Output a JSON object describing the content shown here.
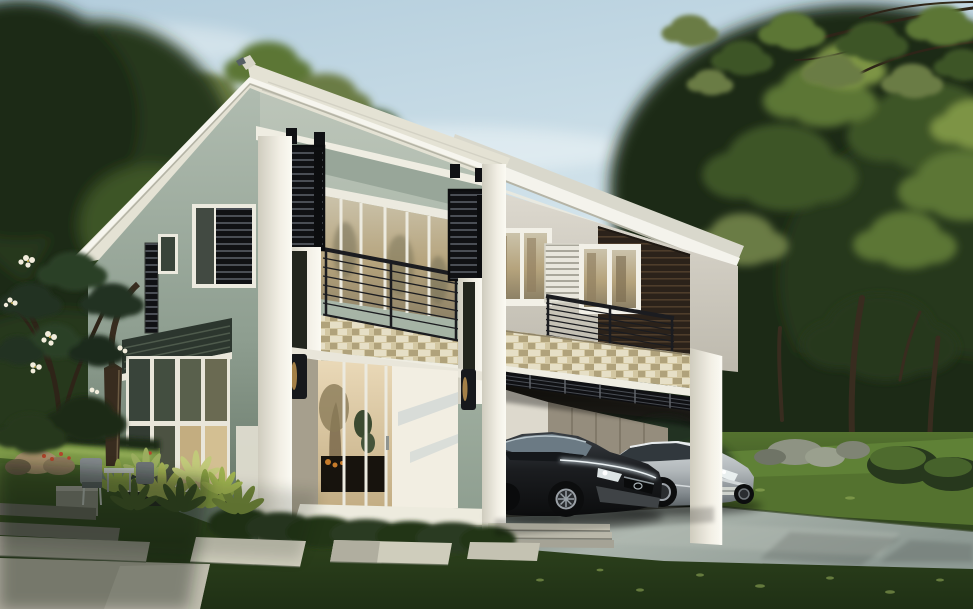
{
  "scene": {
    "type": "architectural-exterior-render",
    "description": "Photorealistic render of a modern two-storey tropical house with sage-green and white walls, black louvre screen panels, stone veneer bands, balconies with black railings, a carport sheltering two cars (dark hatchback and silver sedan), a concrete driveway, stepping-stone path, lawn and dense surrounding trees under a pale blue sky.",
    "objects": [
      "sky",
      "clouds",
      "tree-canopy-left",
      "tree-canopy-right",
      "overhanging-branch",
      "house",
      "left-wing-roof",
      "right-wing-roof",
      "balcony-left",
      "balcony-right",
      "louvre-panels",
      "stone-veneer-bands",
      "wood-slat-wall",
      "windows",
      "sliding-glass-doors",
      "wall-sconces",
      "carport",
      "carport-columns",
      "dark-hatchback-car",
      "silver-sedan-car",
      "driveway",
      "steps",
      "stepping-stones",
      "lawn",
      "garden-shrubs",
      "planter-box",
      "outdoor-furniture",
      "rocks",
      "plumeria-tree",
      "hedges"
    ]
  },
  "palette": {
    "sky-top": "#b3cddc",
    "sky-mid": "#d6e6ed",
    "sky-low": "#eef3f2",
    "cloud": "#f6fafa",
    "foliage-deep": "#1d2b16",
    "foliage-dark": "#27381d",
    "foliage-mid": "#3d5526",
    "foliage-light": "#5c7634",
    "foliage-bright": "#7d9445",
    "foliage-pale": "#9aad5e",
    "foliage-olive": "#6b7b44",
    "trunk": "#382c1f",
    "branch": "#2e2418",
    "wall-sage": "#b2bdb2",
    "wall-sage-dark": "#93a295",
    "wall-sage-deep": "#64735f",
    "wall-warm": "#d6d3c9",
    "fascia": "#f4f3ec",
    "soffit": "#c9c8ba",
    "roof-cream": "#e4e2d4",
    "roof-gray": "#d9d8cc",
    "column-white": "#efece2",
    "column-shade": "#d2cfc2",
    "louver-black": "#101114",
    "louver-gap": "#4a4e55",
    "rail-black": "#1b1c20",
    "stone-tan": "#d3c7a2",
    "stone-light": "#e6dfc6",
    "stone-dark": "#b0a27b",
    "wood-dark": "#2b221a",
    "wood-light": "#4e3d2b",
    "awning-dark": "#2c362e",
    "glass-dark": "#39443a",
    "glass-warm": "#b5a37c",
    "interior-warm": "#dcc9a4",
    "furniture-dark": "#17130d",
    "accent-orange": "#c77b2a",
    "lawn-bright": "#7d9a48",
    "lawn-mid": "#54722f",
    "lawn-dark": "#33491f",
    "lawn-shadow": "#1f3015",
    "drive-light": "#a9b3ab",
    "drive-mid": "#8d9993",
    "drive-dark": "#75827e",
    "paver-light": "#d0cebd",
    "paver-mid": "#a8a698",
    "paver-dark": "#6a6a60",
    "rock-tan": "#a7906c",
    "rock-gray": "#8e9383",
    "car-dark": "#1b1d20",
    "car-silver": "#b2b8bb",
    "wheel": "#0c0d0e",
    "rim": "#9aa0a6",
    "headlight": "#e9efef",
    "flower-white": "#f2eddc",
    "flower-center": "#d8b84a",
    "flower-red": "#b4452c"
  }
}
